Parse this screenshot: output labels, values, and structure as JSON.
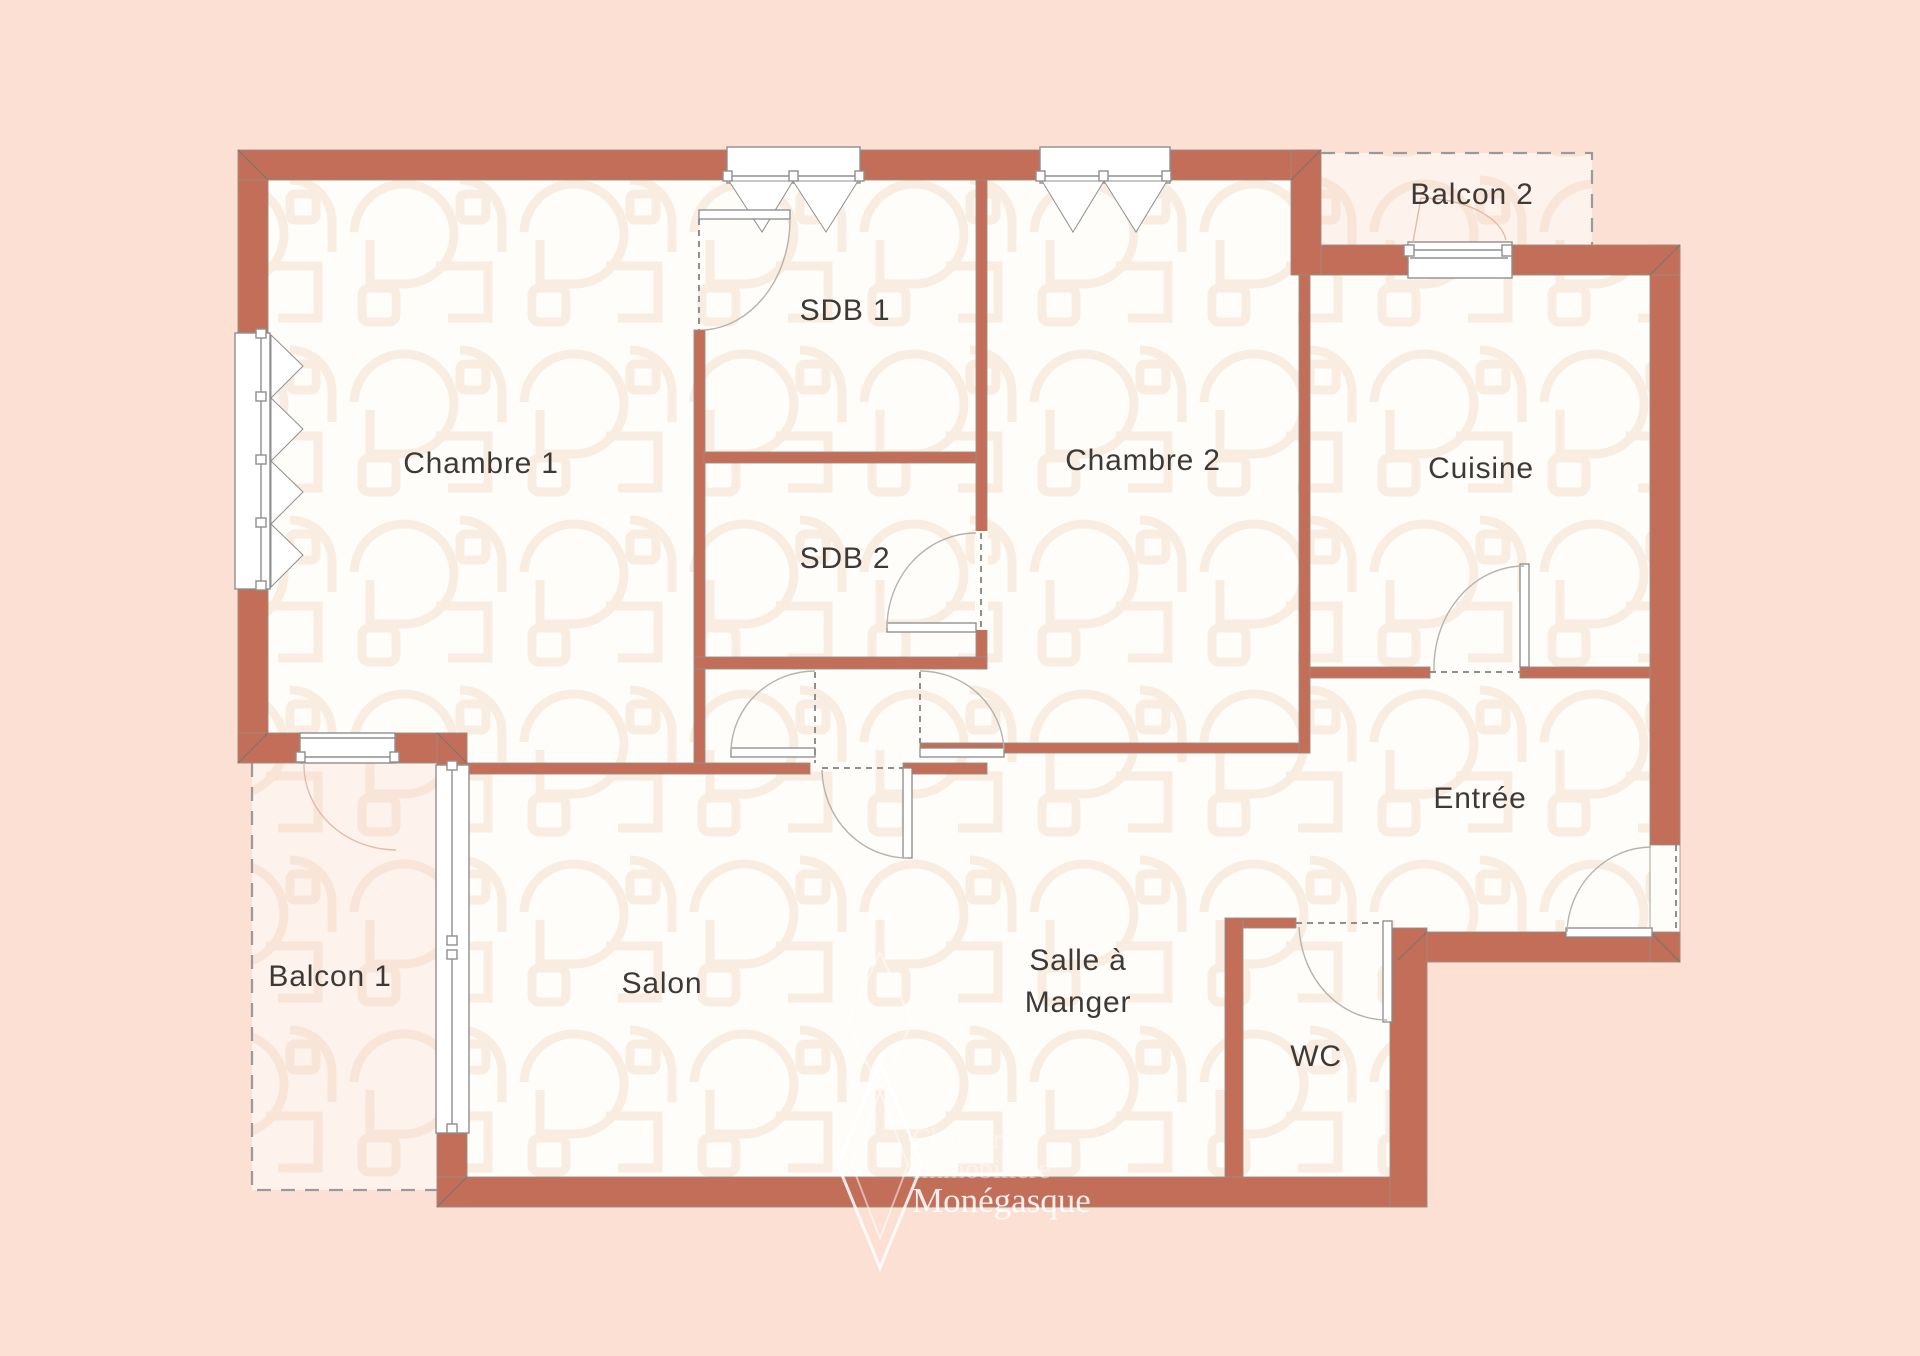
{
  "title": "Plan d'appartement",
  "colors": {
    "background": "#fce0d4",
    "wall": "#c26e58",
    "wall_outline": "#9b8d84",
    "floor": "#fffdfa",
    "pattern": "#f8e8da",
    "balcony_tint": "#f7cdb9",
    "label_text": "#3d3936",
    "door_line": "#b5b3ac",
    "frame_line": "#8f8f8f"
  },
  "rooms": {
    "chambre1": {
      "label": "Chambre 1"
    },
    "sdb1": {
      "label": "SDB 1"
    },
    "sdb2": {
      "label": "SDB 2"
    },
    "chambre2": {
      "label": "Chambre 2"
    },
    "cuisine": {
      "label": "Cuisine"
    },
    "balcon2": {
      "label": "Balcon 2"
    },
    "entree": {
      "label": "Entrée"
    },
    "salon": {
      "label": "Salon"
    },
    "salle_a_manger": {
      "line1": "Salle à",
      "line2": "Manger"
    },
    "wc": {
      "label": "WC"
    },
    "balcon1": {
      "label": "Balcon 1"
    }
  },
  "watermark": {
    "line1": "Chambre",
    "line2": "Immobilière",
    "line3": "Monégasque"
  }
}
